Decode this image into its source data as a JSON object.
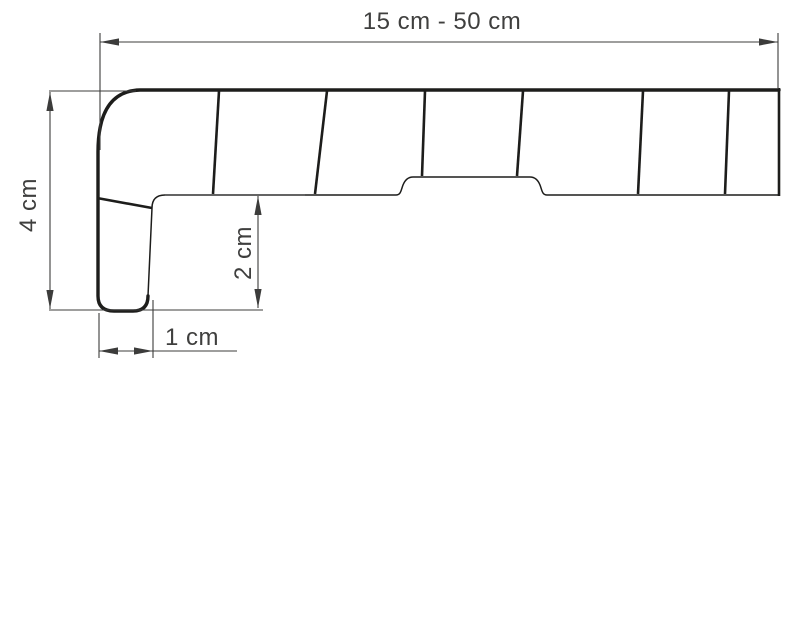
{
  "diagram": {
    "subject": "window-sill-profile-cross-section",
    "dimensions": {
      "overall_width": {
        "label": "15 cm - 50 cm",
        "orientation": "horizontal",
        "position": "top"
      },
      "overall_height": {
        "label": "4 cm",
        "orientation": "vertical",
        "position": "left"
      },
      "front_nose_drop": {
        "label": "2 cm",
        "orientation": "vertical",
        "position": "inner"
      },
      "front_nose_width": {
        "label": "1 cm",
        "orientation": "horizontal",
        "position": "bottom"
      }
    },
    "profile": {
      "internal_rib_count": 6,
      "has_bottom_mounting_groove": true,
      "rounded_front_nose": true
    }
  },
  "colors": {
    "background": "#ffffff",
    "profile_stroke": "#1d1d1b",
    "dimension_stroke": "#3c3c3b",
    "label_text": "#3f3f3e"
  }
}
